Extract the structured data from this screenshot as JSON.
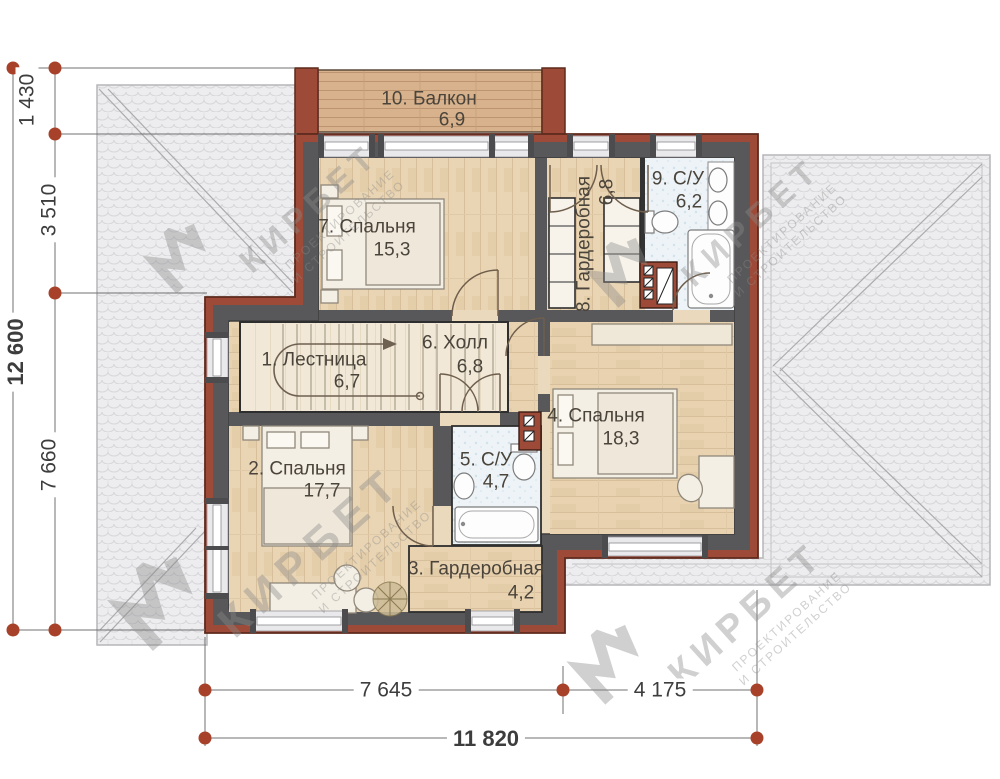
{
  "plan": {
    "rooms": [
      {
        "name": "10. Балкон",
        "area": "6,9"
      },
      {
        "name": "7. Спальня",
        "area": "15,3"
      },
      {
        "name": "8. Гардеробная",
        "area": "6,8"
      },
      {
        "name": "9. С/У",
        "area": "6,2"
      },
      {
        "name": "1. Лестница",
        "area": "6,7"
      },
      {
        "name": "6. Холл",
        "area": "6,8"
      },
      {
        "name": "4. Спальня",
        "area": "18,3"
      },
      {
        "name": "2. Спальня",
        "area": "17,7"
      },
      {
        "name": "5. С/У",
        "area": "4,7"
      },
      {
        "name": "3. Гардеробная",
        "area": "4,2"
      }
    ],
    "dimensions": {
      "v1": "1 430",
      "v2": "3 510",
      "v3": "7 660",
      "v_total": "12 600",
      "h1": "7 645",
      "h2": "4 175",
      "h_total": "11 820"
    },
    "watermark": {
      "brand": "КИРБЕТ",
      "sub1": "ПРОЕКТИРОВАНИЕ",
      "sub2": "И СТРОИТЕЛЬСТВО"
    },
    "colors": {
      "wall_accent": "#9d4a38",
      "wall": "#58585a",
      "marker": "#a84129",
      "wood": "#e9d5b4",
      "roof": "#ededef",
      "tile": "#edf3f7"
    }
  }
}
